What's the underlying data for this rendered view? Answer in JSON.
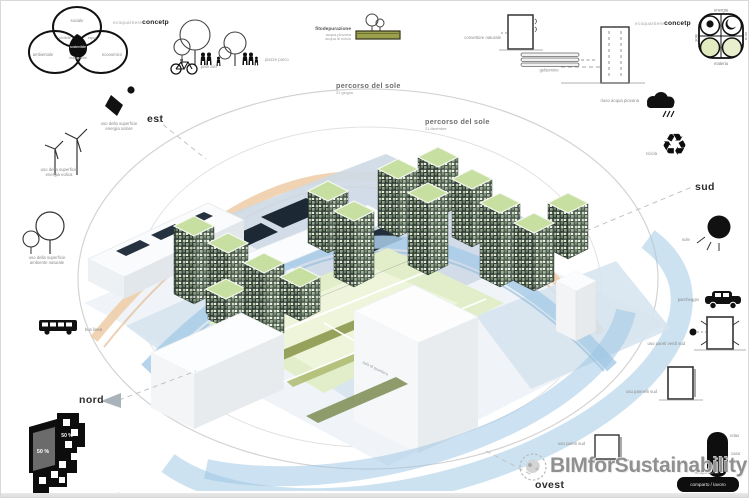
{
  "concept": {
    "prefix": "ecoquartiere",
    "bold": "concetp"
  },
  "venn": {
    "top": "sociale",
    "left": "ambientale",
    "right": "economico",
    "cross_left": "vivibile",
    "cross_right": "equo",
    "center": "sostenibile",
    "cross_bottom": "realizzabile"
  },
  "compass": {
    "est": "est",
    "sud": "sud",
    "nord": "nord",
    "ovest": "ovest"
  },
  "sun_paths": {
    "summer_title": "percorso del sole",
    "summer_date": "21 giugno",
    "winter_title": "percorso del sole",
    "winter_date": "21 dicembre"
  },
  "icons_top": {
    "park_label": "piazze parco",
    "bike_label": "park bici",
    "phyto_title": "fitodepurazione",
    "phyto_line1": "acqua piovana",
    "phyto_line2": "acqua di riciclo",
    "convector_label": "convettore naturale",
    "jasmine_label": "gelsomino"
  },
  "icons_left": {
    "solar_line1": "uso della superficie",
    "solar_line2": "energia solare",
    "wind_line1": "uso della superficie",
    "wind_line2": "energia eolica",
    "nature_line1": "uso della superficie",
    "nature_line2": "ambiente naturale",
    "bus_label": "bus linea"
  },
  "icons_right": {
    "rain_label": "riuso acqua piovana",
    "recycle_label": "ricicla",
    "recycle_glyph": "♻",
    "sun_label": "sole",
    "parking_label": "parcheggio",
    "walls_label": "uso pareti verdi sud",
    "panels_label": "uso pannelli sud",
    "south_wall_label": "uso pareti sud"
  },
  "matrix": {
    "top": "energia",
    "left": "sole",
    "right": "luna",
    "bottom": "materia"
  },
  "plan": {
    "pct_a": "50 %",
    "pct_b": "50 %"
  },
  "pills": {
    "v_label1": "relax",
    "v_label2": "casa",
    "h_above": "tempo libero",
    "h_text": "comparto / lavoro"
  },
  "watermark": {
    "text": "BIMforSustainability"
  },
  "scene": {
    "slab_label": "sala di quartiere"
  },
  "colors": {
    "accent_blue": "#a8cce6",
    "accent_orange": "#edcba4",
    "roof_green": "#c8dfa2"
  }
}
